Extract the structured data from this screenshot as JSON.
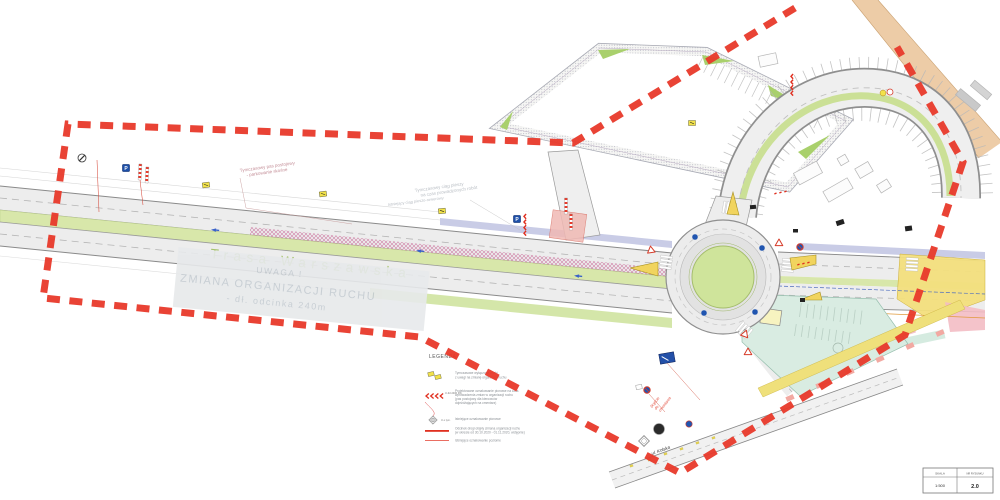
{
  "drawing": {
    "watermark": {
      "line1": "UWAGA !",
      "line2": "ZMIANA ORGANIZACJI RUCHU",
      "line3": "- dł. odcinka 240m"
    },
    "streets": {
      "main": "Trasa  Warszawska",
      "south": "ul. Kolska"
    },
    "notes": {
      "temp_parking_1": "Tymczasowy pas postojowy",
      "temp_parking_2": "- parkowanie skośne",
      "temp_path_1": "Tymczasowy ciąg pieszy",
      "temp_path_2": "na czas prowadzonych robót",
      "existing_path": "Istniejący ciąg pieszo-rowerowy",
      "cemetery_note_1": "Dojście",
      "cemetery_note_2": "do",
      "cemetery_note_3": "cmentarza"
    },
    "signs": {
      "parking_letter": "P"
    },
    "legend": {
      "title": "LEGENDA:",
      "item1": {
        "line1": "Tymczasowe wyłączone znaki",
        "line2": "z uwagi na zmianę organizacji ruchu"
      },
      "item2": {
        "code": "U-3d 2400 Poj.",
        "line1": "Projektowane oznakowanie pionowe na czas",
        "line2": "wprowadzenia zmian w  organizacji ruchu",
        "line3": "(pas postojowy dla kierowców",
        "line4": "dojeżdżających na cmentarz)"
      },
      "item3": {
        "code": "U-x tym.",
        "line1": "Istniejące oznakowanie pionowe"
      },
      "item4": {
        "line1": "Odcinek drogi objęty zmianą organizacji ruchu",
        "line2": "(w okresie od 30.10.2020 - 01.11.2020, wstępnie)"
      },
      "item5": {
        "line1": "Istniejące oznakowanie poziome"
      }
    },
    "titleblock": {
      "scale_label": "SKALA",
      "scale_value": "1:500",
      "drawing_label": "NR RYSUNKU",
      "drawing_value": "2.0"
    },
    "colors": {
      "boundary_red": "#e8392a",
      "grass_green": "#d8e7aa",
      "asphalt": "#ededed",
      "island_yellow": "#f1d45e",
      "work_zone_pink": "#f0b9b4",
      "path_yellow": "#efe07b",
      "parking_mint": "#d9ece2",
      "sidewalk_lavender": "#c9cce6"
    }
  }
}
